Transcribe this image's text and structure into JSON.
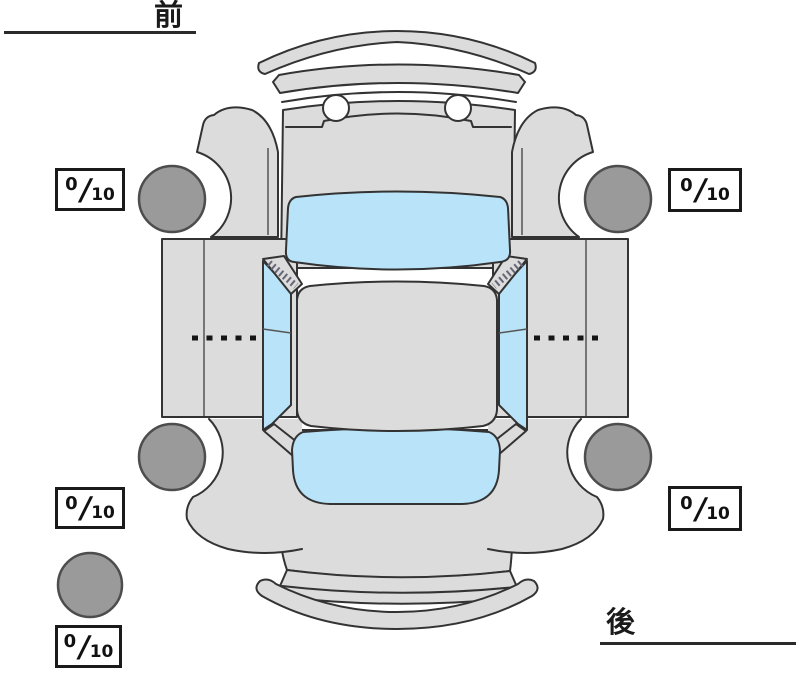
{
  "diagram": {
    "kind": "vehicle-top-view-tire-tread-diagram",
    "front_label": "前",
    "rear_label": "後",
    "score_separator": "/",
    "tires": {
      "front_left": {
        "position": "front-left",
        "value": "0",
        "max": "10"
      },
      "front_right": {
        "position": "front-right",
        "value": "0",
        "max": "10"
      },
      "rear_left": {
        "position": "rear-left",
        "value": "0",
        "max": "10"
      },
      "rear_right": {
        "position": "rear-right",
        "value": "0",
        "max": "10"
      },
      "spare": {
        "position": "spare",
        "value": "0",
        "max": "10"
      }
    },
    "wheels": [
      "front-left",
      "front-right",
      "rear-left",
      "rear-right",
      "spare"
    ],
    "colors": {
      "body": "#dcdcdc",
      "glass": "#b9e3f8",
      "wheel": "#9a9a9a",
      "outline": "#333333",
      "ink": "#1a1a1a",
      "background": "#ffffff"
    }
  }
}
